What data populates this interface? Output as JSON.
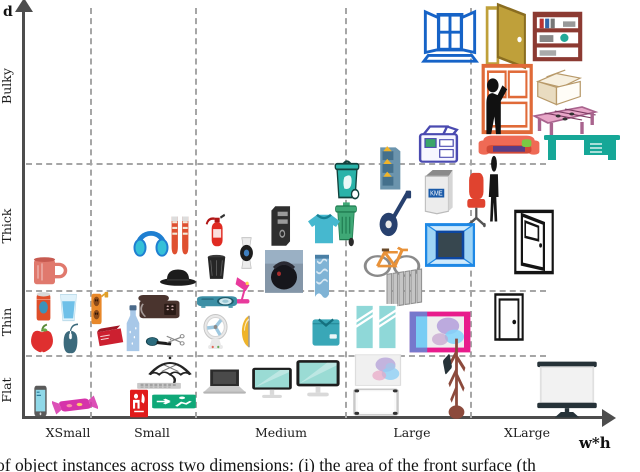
{
  "figure": {
    "caption_fragment": "of object instances across two dimensions: (i) the area of the front surface (th",
    "grid_style": "dashed",
    "grid_color": "#a6a6a6",
    "axis_color": "#4d4d4d"
  },
  "chart_data": {
    "type": "scatter",
    "xlabel": "w*h",
    "ylabel": "d",
    "x_categories": [
      "XSmall",
      "Small",
      "Medium",
      "Large",
      "XLarge"
    ],
    "y_categories": [
      "Flat",
      "Thin",
      "Thick",
      "Bulky"
    ],
    "legend": "none",
    "grid": "dashed category separators",
    "points": [
      {
        "label": "open window",
        "icon": "window-open",
        "x": "Large",
        "y": "Bulky",
        "color": "#1663c7",
        "px": [
          421,
          9,
          58,
          58
        ]
      },
      {
        "label": "open door",
        "icon": "door-open",
        "x": "XLarge",
        "y": "Bulky",
        "color": "#bfa03a",
        "px": [
          479,
          1,
          54,
          70
        ]
      },
      {
        "label": "bookshelf",
        "icon": "bookshelf",
        "x": "XLarge",
        "y": "Bulky",
        "color": "#8c3a32",
        "px": [
          530,
          9,
          55,
          55
        ]
      },
      {
        "label": "cardboard boxes",
        "icon": "boxes",
        "x": "XLarge",
        "y": "Bulky",
        "color": "#b89a6a",
        "px": [
          534,
          62,
          50,
          46
        ]
      },
      {
        "label": "person at cabinet",
        "icon": "cabinet-person",
        "x": "XLarge",
        "y": "Bulky",
        "color": "#e06a38",
        "px": [
          472,
          60,
          64,
          78
        ]
      },
      {
        "label": "foosball table",
        "icon": "foosball-table",
        "x": "XLarge",
        "y": "Bulky",
        "color": "#e8a7c8",
        "px": [
          531,
          101,
          68,
          40
        ]
      },
      {
        "label": "couch",
        "icon": "couch",
        "x": "XLarge",
        "y": "Bulky",
        "color": "#ef6a55",
        "px": [
          477,
          128,
          64,
          38
        ]
      },
      {
        "label": "desk",
        "icon": "desk",
        "x": "XLarge",
        "y": "Bulky",
        "color": "#16a797",
        "px": [
          542,
          126,
          80,
          40
        ]
      },
      {
        "label": "photocopier",
        "icon": "photocopier",
        "x": "Large",
        "y": "Bulky",
        "color": "#4a4ab0",
        "px": [
          414,
          121,
          49,
          44
        ]
      },
      {
        "label": "recycling bin",
        "icon": "eco-bin",
        "x": "Large",
        "y": "Thick",
        "color": "#2ab3a9",
        "px": [
          329,
          157,
          36,
          45
        ]
      },
      {
        "label": "file cabinet",
        "icon": "file-cabinet",
        "x": "Large",
        "y": "Thick",
        "color": "#6b94ad",
        "px": [
          374,
          141,
          31,
          51
        ]
      },
      {
        "label": "vending machine",
        "icon": "vending-machine",
        "x": "Large",
        "y": "Thick",
        "color": "#ececec",
        "text": "KME",
        "px": [
          418,
          165,
          42,
          50
        ]
      },
      {
        "label": "office chair",
        "icon": "office-chair",
        "x": "XLarge",
        "y": "Thick",
        "color": "#e0432f",
        "px": [
          461,
          170,
          36,
          58
        ]
      },
      {
        "label": "person",
        "icon": "person",
        "x": "XLarge",
        "y": "Thick",
        "color": "#151515",
        "px": [
          481,
          155,
          26,
          70
        ]
      },
      {
        "label": "window",
        "icon": "window-dark",
        "x": "Large",
        "y": "Thick",
        "color": "#1e88e5",
        "px": [
          424,
          221,
          52,
          48
        ]
      },
      {
        "label": "electric guitar",
        "icon": "guitar",
        "x": "Large",
        "y": "Thick",
        "color": "#27406e",
        "px": [
          376,
          188,
          36,
          52
        ]
      },
      {
        "label": "bicycle",
        "icon": "bicycle",
        "x": "Large",
        "y": "Thick",
        "color": "#e8923a",
        "px": [
          363,
          235,
          58,
          46
        ]
      },
      {
        "label": "wheelie bin",
        "icon": "wheelie-bin",
        "x": "Large",
        "y": "Thick",
        "color": "#3fa876",
        "px": [
          331,
          200,
          30,
          48
        ]
      },
      {
        "label": "open door outline",
        "icon": "door-open-outline",
        "x": "XLarge",
        "y": "Thick",
        "color": "#141414",
        "px": [
          512,
          208,
          44,
          68
        ]
      },
      {
        "label": "computer tower",
        "icon": "tower-pc",
        "x": "Medium",
        "y": "Thick",
        "color": "#2e2e2e",
        "px": [
          266,
          204,
          31,
          44
        ]
      },
      {
        "label": "sweater",
        "icon": "sweater",
        "x": "Medium",
        "y": "Thick",
        "color": "#46b8cf",
        "px": [
          304,
          209,
          40,
          38
        ]
      },
      {
        "label": "fire extinguisher",
        "icon": "fire-extinguisher",
        "x": "Medium",
        "y": "Thick",
        "color": "#e02b22",
        "px": [
          203,
          212,
          29,
          38
        ]
      },
      {
        "label": "wrist watch",
        "icon": "watch",
        "x": "Medium",
        "y": "Thick",
        "color": "#ececec",
        "px": [
          233,
          236,
          27,
          34
        ]
      },
      {
        "label": "waste basket",
        "icon": "trashcan",
        "x": "Medium",
        "y": "Thick",
        "color": "#262626",
        "px": [
          202,
          251,
          29,
          31
        ]
      },
      {
        "label": "backpack photo",
        "icon": "backpack-photo",
        "x": "Medium",
        "y": "Thick",
        "color": "#8496a8",
        "px": [
          264,
          249,
          40,
          45
        ]
      },
      {
        "label": "towel",
        "icon": "towel",
        "x": "Medium",
        "y": "Thick",
        "color": "#7fb3d5",
        "px": [
          308,
          251,
          28,
          51
        ]
      },
      {
        "label": "desk lamp",
        "icon": "desk-lamp",
        "x": "Medium",
        "y": "Thick",
        "color": "#e83a9c",
        "px": [
          234,
          272,
          31,
          35
        ]
      },
      {
        "label": "headphones",
        "icon": "headphones",
        "x": "Small",
        "y": "Thick",
        "color": "#1f7fd1",
        "px": [
          131,
          222,
          40,
          38
        ]
      },
      {
        "label": "sneakers",
        "icon": "sneakers",
        "x": "Small",
        "y": "Thick",
        "color": "#df5030",
        "px": [
          166,
          213,
          28,
          46
        ]
      },
      {
        "label": "hat",
        "icon": "hat",
        "x": "Small",
        "y": "Thick",
        "color": "#1c1c1c",
        "px": [
          158,
          263,
          40,
          26
        ]
      },
      {
        "label": "mug",
        "icon": "mug",
        "x": "XSmall",
        "y": "Thick",
        "color": "#e0796d",
        "px": [
          29,
          252,
          40,
          38
        ]
      },
      {
        "label": "can",
        "icon": "soda-can",
        "x": "XSmall",
        "y": "Thin",
        "color": "#df4e29",
        "px": [
          31,
          289,
          25,
          35
        ]
      },
      {
        "label": "glass of water",
        "icon": "water-glass",
        "x": "XSmall",
        "y": "Thin",
        "color": "#6fc0e8",
        "px": [
          57,
          292,
          23,
          31
        ]
      },
      {
        "label": "apple",
        "icon": "apple",
        "x": "XSmall",
        "y": "Thin",
        "color": "#df2f2f",
        "px": [
          28,
          323,
          28,
          31
        ]
      },
      {
        "label": "computer mouse",
        "icon": "computer-mouse",
        "x": "XSmall",
        "y": "Thin",
        "color": "#3c6a7c",
        "px": [
          58,
          321,
          25,
          33
        ]
      },
      {
        "label": "power strip",
        "icon": "power-strip",
        "x": "Small",
        "y": "Thin",
        "color": "#e8882a",
        "px": [
          86,
          289,
          24,
          38
        ]
      },
      {
        "label": "book",
        "icon": "book",
        "x": "Small",
        "y": "Thin",
        "color": "#cc2030",
        "px": [
          94,
          321,
          32,
          31
        ]
      },
      {
        "label": "water bottle",
        "icon": "water-bottle",
        "x": "Small",
        "y": "Thin",
        "color": "#a8c8e8",
        "px": [
          119,
          304,
          28,
          51
        ]
      },
      {
        "label": "telephone",
        "icon": "telephone",
        "x": "Small",
        "y": "Thin",
        "color": "#4a342e",
        "px": [
          136,
          291,
          47,
          32
        ]
      },
      {
        "label": "microphone",
        "icon": "microphone",
        "x": "Small",
        "y": "Thin",
        "color": "#2c6c7e",
        "px": [
          145,
          332,
          29,
          20
        ]
      },
      {
        "label": "scissors",
        "icon": "scissors",
        "x": "Small",
        "y": "Thin",
        "color": "#8a8a8a",
        "px": [
          164,
          331,
          22,
          19
        ]
      },
      {
        "label": "projector",
        "icon": "projector",
        "x": "Medium",
        "y": "Thin",
        "color": "#3c8fa5",
        "px": [
          196,
          291,
          42,
          21
        ]
      },
      {
        "label": "fan",
        "icon": "table-fan",
        "x": "Medium",
        "y": "Thin",
        "color": "#e9e9e9",
        "px": [
          197,
          312,
          37,
          40
        ]
      },
      {
        "label": "wall light",
        "icon": "wall-light",
        "x": "Medium",
        "y": "Thin",
        "color": "#efb42a",
        "px": [
          236,
          314,
          20,
          35
        ]
      },
      {
        "label": "folded shirt",
        "icon": "folded-shirt",
        "x": "Medium",
        "y": "Thin",
        "color": "#39a7b7",
        "px": [
          308,
          315,
          36,
          35
        ]
      },
      {
        "label": "radiator",
        "icon": "radiator",
        "x": "Large",
        "y": "Thick",
        "color": "#c5c5c5",
        "px": [
          384,
          266,
          40,
          44
        ]
      },
      {
        "label": "window panes",
        "icon": "window-panes",
        "x": "Large",
        "y": "Thin",
        "color": "#8fd8d8",
        "px": [
          352,
          301,
          48,
          52
        ]
      },
      {
        "label": "framed painting",
        "icon": "painting-framed",
        "x": "Large",
        "y": "Thin",
        "color": "#e81c8c",
        "px": [
          408,
          308,
          64,
          48
        ]
      },
      {
        "label": "closed door",
        "icon": "door-closed",
        "x": "XLarge",
        "y": "Thin",
        "color": "#141414",
        "px": [
          488,
          292,
          42,
          50
        ]
      },
      {
        "label": "smartphone",
        "icon": "smartphone",
        "x": "XSmall",
        "y": "Flat",
        "color": "#5a5a5a",
        "px": [
          31,
          385,
          19,
          32
        ]
      },
      {
        "label": "candy bar",
        "icon": "candy-bar",
        "x": "XSmall",
        "y": "Flat",
        "color": "#d633aa",
        "px": [
          52,
          392,
          46,
          26
        ]
      },
      {
        "label": "umbrella",
        "icon": "umbrella",
        "x": "Small",
        "y": "Flat",
        "color": "#242424",
        "px": [
          146,
          356,
          48,
          31
        ]
      },
      {
        "label": "keyboard",
        "icon": "keyboard",
        "x": "Small",
        "y": "Flat",
        "color": "#c9c9c9",
        "px": [
          136,
          379,
          46,
          14
        ]
      },
      {
        "label": "fire safety sign",
        "icon": "fire-sign",
        "x": "Small",
        "y": "Flat",
        "color": "#e01b1b",
        "px": [
          127,
          389,
          24,
          29
        ]
      },
      {
        "label": "exit sign",
        "icon": "exit-sign",
        "x": "Small",
        "y": "Flat",
        "color": "#0fa878",
        "px": [
          151,
          391,
          46,
          21
        ]
      },
      {
        "label": "laptop",
        "icon": "laptop",
        "x": "Medium",
        "y": "Flat",
        "color": "#2b2b2b",
        "px": [
          201,
          366,
          46,
          35
        ]
      },
      {
        "label": "monitor",
        "icon": "monitor",
        "x": "Medium",
        "y": "Flat",
        "color": "#9adbd4",
        "px": [
          250,
          366,
          44,
          35
        ]
      },
      {
        "label": "large monitor",
        "icon": "monitor",
        "x": "Medium",
        "y": "Flat",
        "color": "#9adbd4",
        "px": [
          294,
          358,
          48,
          42
        ]
      },
      {
        "label": "abstract painting",
        "icon": "painting-abstract",
        "x": "Large",
        "y": "Flat",
        "color": "#f0f0f0",
        "px": [
          353,
          353,
          50,
          36
        ]
      },
      {
        "label": "whiteboard",
        "icon": "whiteboard",
        "x": "Large",
        "y": "Flat",
        "color": "#fafafa",
        "px": [
          352,
          387,
          48,
          31
        ]
      },
      {
        "label": "coat rack",
        "icon": "coat-rack",
        "x": "Large",
        "y": "Flat",
        "color": "#8c4a3c",
        "px": [
          438,
          332,
          37,
          89
        ]
      },
      {
        "label": "projection screen",
        "icon": "projection-screen",
        "x": "XLarge",
        "y": "Flat",
        "color": "#f2f2f2",
        "px": [
          532,
          357,
          70,
          62
        ]
      }
    ]
  }
}
